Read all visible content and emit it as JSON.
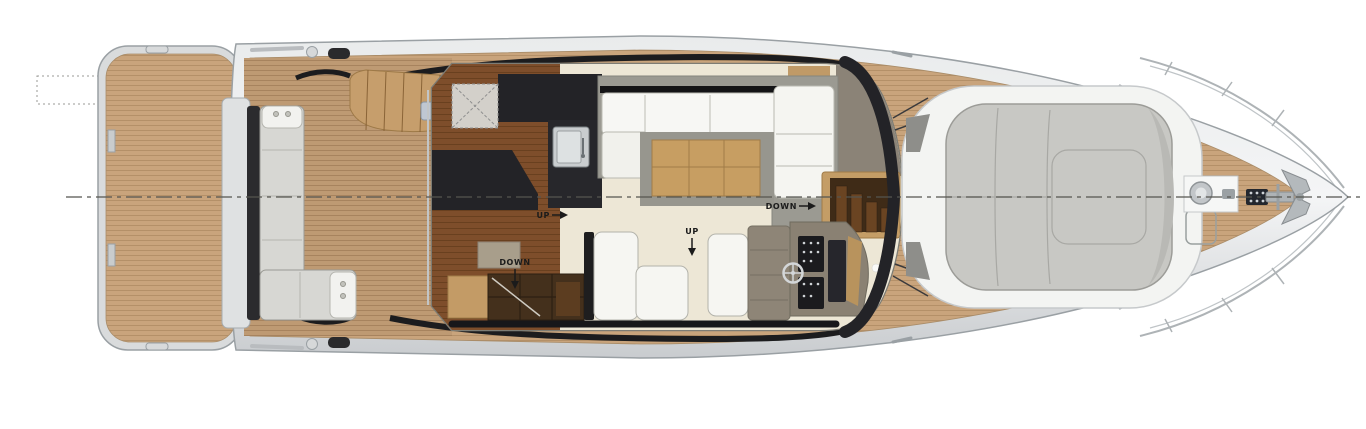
{
  "labels": {
    "up_galley": "UP",
    "down_forward_stairs": "DOWN",
    "up_cockpit": "UP",
    "down_aft_stairs": "DOWN"
  },
  "colors": {
    "teak_deck": "#C9A47C",
    "cockpit_teak": "#BE9A73",
    "wood_floor": "#7E4E2B",
    "carpet": "#EDE7D6",
    "hull_silver": "#D9DBDC",
    "accent_black": "#1C1C1E",
    "sofa_white": "#F6F6F2",
    "upholstery_grey": "#D7D7D3",
    "sunpad_grey": "#C8C8C4",
    "table_tan": "#C79E62",
    "counter_dark": "#232327",
    "stair_wood": "#44301C"
  }
}
